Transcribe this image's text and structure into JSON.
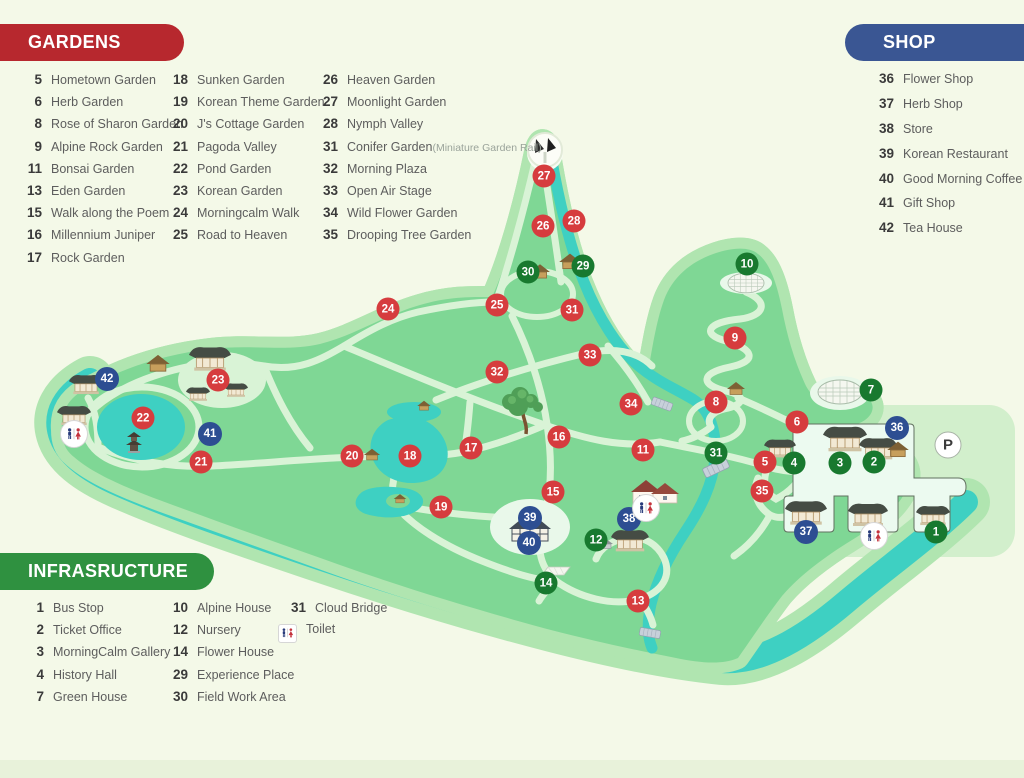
{
  "legend": {
    "gardens": {
      "title": "GARDENS",
      "color": "#b7282e",
      "columns": [
        [
          {
            "n": "5",
            "label": "Hometown Garden"
          },
          {
            "n": "6",
            "label": "Herb Garden"
          },
          {
            "n": "8",
            "label": "Rose of Sharon Garden"
          },
          {
            "n": "9",
            "label": "Alpine Rock Garden"
          },
          {
            "n": "11",
            "label": "Bonsai Garden"
          },
          {
            "n": "13",
            "label": "Eden Garden"
          },
          {
            "n": "15",
            "label": "Walk along the Poem"
          },
          {
            "n": "16",
            "label": "Millennium Juniper"
          },
          {
            "n": "17",
            "label": "Rock Garden"
          }
        ],
        [
          {
            "n": "18",
            "label": "Sunken Garden"
          },
          {
            "n": "19",
            "label": "Korean Theme Garden"
          },
          {
            "n": "20",
            "label": "J's Cottage Garden"
          },
          {
            "n": "21",
            "label": "Pagoda Valley"
          },
          {
            "n": "22",
            "label": "Pond Garden"
          },
          {
            "n": "23",
            "label": "Korean Garden"
          },
          {
            "n": "24",
            "label": "Morningcalm Walk"
          },
          {
            "n": "25",
            "label": "Road to Heaven"
          }
        ],
        [
          {
            "n": "26",
            "label": "Heaven Garden"
          },
          {
            "n": "27",
            "label": "Moonlight Garden"
          },
          {
            "n": "28",
            "label": "Nymph Valley"
          },
          {
            "n": "31",
            "label": "Conifer Garden",
            "sub": "(Miniature Garden Rail)"
          },
          {
            "n": "32",
            "label": "Morning Plaza"
          },
          {
            "n": "33",
            "label": "Open Air Stage"
          },
          {
            "n": "34",
            "label": "Wild Flower Garden"
          },
          {
            "n": "35",
            "label": "Drooping Tree Garden"
          }
        ]
      ]
    },
    "shop": {
      "title": "SHOP",
      "color": "#3a5693",
      "items": [
        {
          "n": "36",
          "label": "Flower Shop"
        },
        {
          "n": "37",
          "label": "Herb Shop"
        },
        {
          "n": "38",
          "label": "Store"
        },
        {
          "n": "39",
          "label": "Korean Restaurant"
        },
        {
          "n": "40",
          "label": "Good Morning Coffee"
        },
        {
          "n": "41",
          "label": "Gift Shop"
        },
        {
          "n": "42",
          "label": "Tea House"
        }
      ]
    },
    "infrastructure": {
      "title": "INFRASRUCTURE",
      "color": "#2f9140",
      "columns": [
        [
          {
            "n": "1",
            "label": "Bus Stop"
          },
          {
            "n": "2",
            "label": "Ticket Office"
          },
          {
            "n": "3",
            "label": "MorningCalm Gallery"
          },
          {
            "n": "4",
            "label": "History Hall"
          },
          {
            "n": "7",
            "label": "Green House"
          }
        ],
        [
          {
            "n": "10",
            "label": "Alpine House"
          },
          {
            "n": "12",
            "label": "Nursery"
          },
          {
            "n": "14",
            "label": "Flower House"
          },
          {
            "n": "29",
            "label": "Experience Place"
          },
          {
            "n": "30",
            "label": "Field Work Area"
          }
        ],
        [
          {
            "n": "31",
            "label": "Cloud Bridge"
          },
          {
            "icon": "toilet",
            "label": "Toilet"
          }
        ]
      ]
    }
  },
  "map": {
    "palette": {
      "land": "#7fd795",
      "ring": "#b0e5b0",
      "water": "#3ed0c2",
      "path": "#d9f3d6",
      "plaza": "#e9f8ea",
      "entrance": "#ecfaf0"
    },
    "marker_colors": {
      "garden": "#d63c3e",
      "infrastructure": "#18792f",
      "shop": "#2d4e92"
    },
    "markers": [
      {
        "n": "5",
        "type": "garden",
        "x": 765,
        "y": 462
      },
      {
        "n": "6",
        "type": "garden",
        "x": 797,
        "y": 422
      },
      {
        "n": "8",
        "type": "garden",
        "x": 716,
        "y": 402
      },
      {
        "n": "9",
        "type": "garden",
        "x": 735,
        "y": 338
      },
      {
        "n": "11",
        "type": "garden",
        "x": 643,
        "y": 450
      },
      {
        "n": "13",
        "type": "garden",
        "x": 638,
        "y": 601
      },
      {
        "n": "15",
        "type": "garden",
        "x": 553,
        "y": 492
      },
      {
        "n": "16",
        "type": "garden",
        "x": 559,
        "y": 437
      },
      {
        "n": "17",
        "type": "garden",
        "x": 471,
        "y": 448
      },
      {
        "n": "18",
        "type": "garden",
        "x": 410,
        "y": 456
      },
      {
        "n": "19",
        "type": "garden",
        "x": 441,
        "y": 507
      },
      {
        "n": "20",
        "type": "garden",
        "x": 352,
        "y": 456
      },
      {
        "n": "21",
        "type": "garden",
        "x": 201,
        "y": 462
      },
      {
        "n": "22",
        "type": "garden",
        "x": 143,
        "y": 418
      },
      {
        "n": "23",
        "type": "garden",
        "x": 218,
        "y": 380
      },
      {
        "n": "24",
        "type": "garden",
        "x": 388,
        "y": 309
      },
      {
        "n": "25",
        "type": "garden",
        "x": 497,
        "y": 305
      },
      {
        "n": "26",
        "type": "garden",
        "x": 543,
        "y": 226
      },
      {
        "n": "27",
        "type": "garden",
        "x": 544,
        "y": 176
      },
      {
        "n": "28",
        "type": "garden",
        "x": 574,
        "y": 221
      },
      {
        "n": "31",
        "type": "garden",
        "x": 572,
        "y": 310
      },
      {
        "n": "32",
        "type": "garden",
        "x": 497,
        "y": 372
      },
      {
        "n": "33",
        "type": "garden",
        "x": 590,
        "y": 355
      },
      {
        "n": "34",
        "type": "garden",
        "x": 631,
        "y": 404
      },
      {
        "n": "35",
        "type": "garden",
        "x": 762,
        "y": 491
      },
      {
        "n": "1",
        "type": "infrastructure",
        "x": 936,
        "y": 532
      },
      {
        "n": "2",
        "type": "infrastructure",
        "x": 874,
        "y": 462
      },
      {
        "n": "3",
        "type": "infrastructure",
        "x": 840,
        "y": 463
      },
      {
        "n": "4",
        "type": "infrastructure",
        "x": 794,
        "y": 463
      },
      {
        "n": "7",
        "type": "infrastructure",
        "x": 871,
        "y": 390
      },
      {
        "n": "10",
        "type": "infrastructure",
        "x": 747,
        "y": 264
      },
      {
        "n": "12",
        "type": "infrastructure",
        "x": 596,
        "y": 540
      },
      {
        "n": "14",
        "type": "infrastructure",
        "x": 546,
        "y": 583
      },
      {
        "n": "29",
        "type": "infrastructure",
        "x": 583,
        "y": 266
      },
      {
        "n": "30",
        "type": "infrastructure",
        "x": 528,
        "y": 272
      },
      {
        "n": "31",
        "type": "infrastructure",
        "x": 716,
        "y": 453
      },
      {
        "n": "36",
        "type": "shop",
        "x": 897,
        "y": 428
      },
      {
        "n": "37",
        "type": "shop",
        "x": 806,
        "y": 532
      },
      {
        "n": "38",
        "type": "shop",
        "x": 629,
        "y": 519
      },
      {
        "n": "39",
        "type": "shop",
        "x": 530,
        "y": 518
      },
      {
        "n": "40",
        "type": "shop",
        "x": 529,
        "y": 543
      },
      {
        "n": "41",
        "type": "shop",
        "x": 210,
        "y": 434
      },
      {
        "n": "42",
        "type": "shop",
        "x": 107,
        "y": 379
      }
    ],
    "icons": [
      {
        "type": "toilet",
        "x": 74,
        "y": 434
      },
      {
        "type": "toilet",
        "x": 646,
        "y": 508
      },
      {
        "type": "toilet",
        "x": 874,
        "y": 536
      },
      {
        "type": "parking",
        "x": 948,
        "y": 445,
        "label": "P"
      }
    ]
  }
}
